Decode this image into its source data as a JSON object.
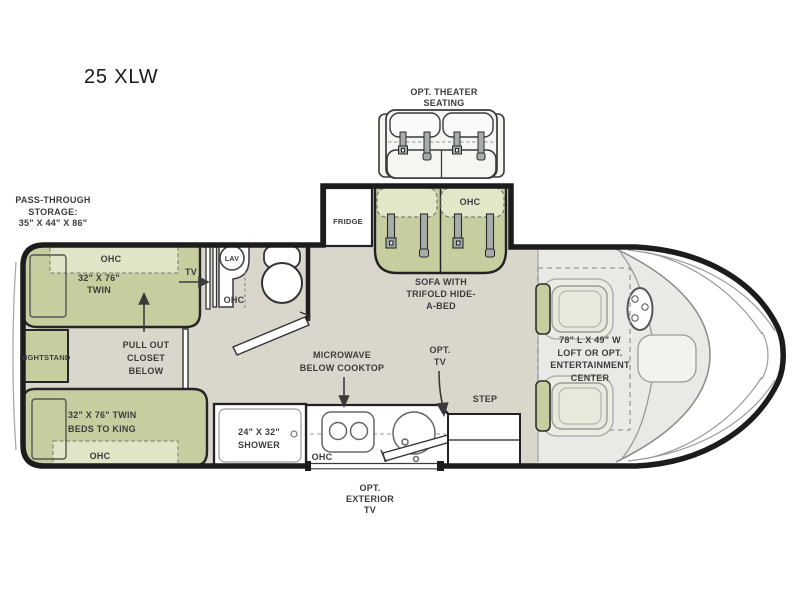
{
  "title": "25 XLW",
  "colors": {
    "floor": "#d9d6cb",
    "cab": "#e9e9e5",
    "green": "#c6cea0",
    "ohc": "#e1e5c8",
    "cushion": "#e3e7ca",
    "wall": "#1c1c1c",
    "text": "#3c3c3c",
    "gray": "#8a8a8a",
    "belt": "#a7aca9",
    "theater": "#f5f5f2",
    "seat": "#e7e9da"
  },
  "labels": {
    "theater": "OPT. THEATER\nSEATING",
    "pass_through": "PASS-THROUGH\nSTORAGE:\n35\" X 44\" X 86\"",
    "ohc": "OHC",
    "twin_top": "32\" X 76\"\nTWIN",
    "tv": "TV",
    "nightstand": "NIGHTSTAND",
    "closet": "PULL OUT\nCLOSET\nBELOW",
    "twin_bottom": "32\" X 76\" TWIN\nBEDS TO KING",
    "lav": "LAV",
    "fridge": "FRIDGE",
    "sofa": "SOFA WITH\nTRIFOLD HIDE-\nA-BED",
    "microwave": "MICROWAVE\nBELOW COOKTOP",
    "opt_tv": "OPT.\nTV",
    "shower": "24\" X 32\"\nSHOWER",
    "step": "STEP",
    "exterior_tv": "OPT.\nEXTERIOR\nTV",
    "loft": "78\" L X 49\" W\nLOFT OR OPT.\nENTERTAINMENT\nCENTER"
  }
}
